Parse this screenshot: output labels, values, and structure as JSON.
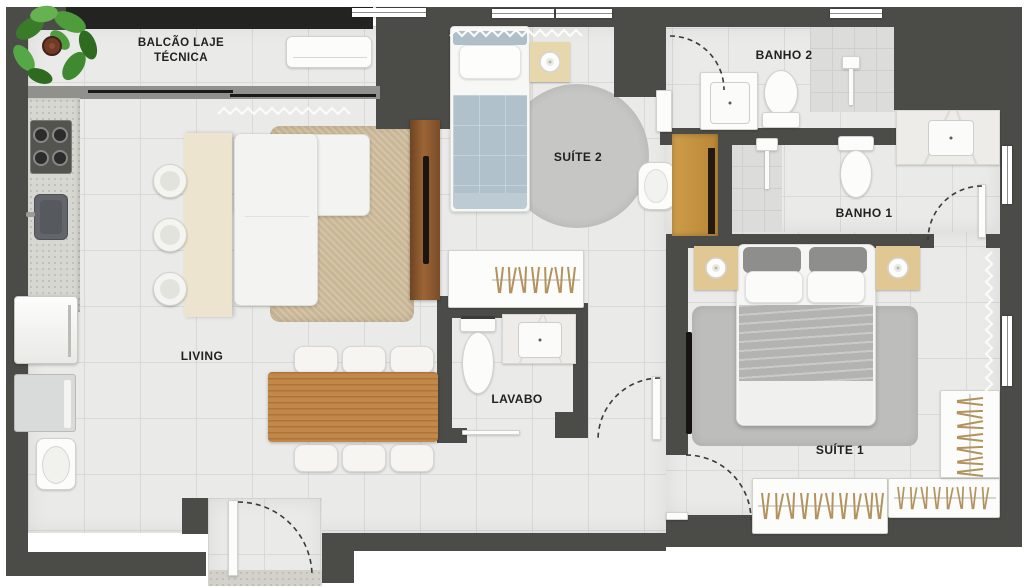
{
  "rooms": {
    "balcony": {
      "label_line1": "BALCÃO LAJE",
      "label_line2": "TÉCNICA"
    },
    "living": {
      "label": "LIVING"
    },
    "suite2": {
      "label": "SUÍTE 2"
    },
    "banho2": {
      "label": "BANHO 2"
    },
    "banho1": {
      "label": "BANHO 1"
    },
    "lavabo": {
      "label": "LAVABO"
    },
    "suite1": {
      "label": "SUÍTE 1"
    }
  },
  "colors": {
    "wall": "#4b4b48",
    "wall-dark": "#232321",
    "floor": "#eaeae8",
    "tile": "#d9d9d7",
    "label": "#212120",
    "wood": "#c1884a",
    "wood-dark": "#7a4d27",
    "tan": "#e0c794",
    "tan-deep": "#c79744",
    "rug-jute": "#c9b795",
    "rug-gray": "#bdbdbb",
    "bed-blue": "#b0c1cc",
    "island": "#ece4cf",
    "hanger": "#b2935f"
  },
  "furniture_icons": [
    "potted-plant-icon",
    "balcony-bench-icon",
    "cooktop-icon",
    "kitchen-sink-icon",
    "refrigerator-icon",
    "washing-machine-icon",
    "laundry-tank-icon",
    "kitchen-island-icon",
    "bar-stool-icon",
    "sofa-icon",
    "tv-icon",
    "tv-panel-icon",
    "dining-table-icon",
    "dining-chair-icon",
    "single-bed-icon",
    "double-bed-icon",
    "nightstand-icon",
    "table-lamp-icon",
    "round-rug-icon",
    "armchair-icon",
    "wardrobe-icon",
    "hanger-icon",
    "toilet-icon",
    "sink-vanity-icon",
    "shower-icon",
    "door-swing-icon",
    "sliding-door-icon",
    "window-icon",
    "curtain-icon"
  ]
}
